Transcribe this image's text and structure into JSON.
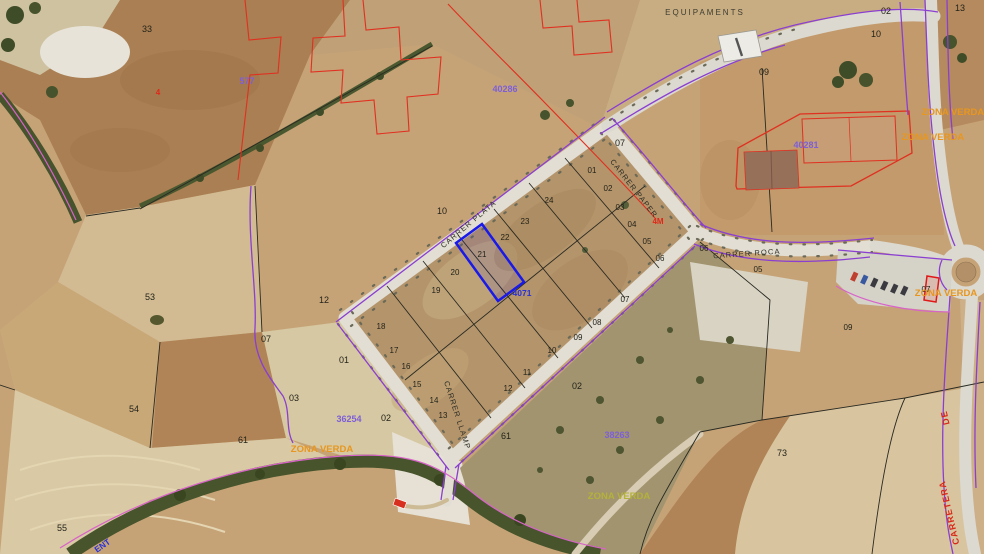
{
  "map_type": "aerial-cadastral-map",
  "palette": {
    "urban_boundary": "#8a3fd0",
    "torrent_line": "#d863c8",
    "survey_overlay_red": "#e03020",
    "selected_parcel_blue": "#1a1ae8",
    "cadastral_ref_purple": "#7d5fd8",
    "zone_label_orange": "#e8961e",
    "parcel_line_black": "#2a2a22",
    "road_fill": "#e2ded4"
  },
  "selected_parcel": {
    "lot_number": "21",
    "outline_color": "#1a1ae8"
  },
  "streets": [
    "CARRER PLATA",
    "CARRER PAPER",
    "CARRER ROCA",
    "CARRER LLAMP",
    "CARRETERA DE"
  ],
  "zones": [
    "EQUIPAMENTS",
    "ZONA VERDA"
  ],
  "cadastral_refs": [
    "577",
    "40286",
    "40281",
    "38263",
    "36254",
    "4071"
  ],
  "labels": [
    {
      "text": "EQUIPAMENTS",
      "kind": "zone-label",
      "color": "#3c3c30"
    },
    {
      "text": "33",
      "kind": "farm-parcel",
      "color": "#23231a"
    },
    {
      "text": "577",
      "kind": "cadastral-ref",
      "color": "#7d5fd8"
    },
    {
      "text": "4",
      "kind": "survey-mark",
      "color": "#e02818"
    },
    {
      "text": "40286",
      "kind": "cadastral-ref",
      "color": "#7d5fd8"
    },
    {
      "text": "02",
      "kind": "farm-parcel",
      "color": "#23231a"
    },
    {
      "text": "10",
      "kind": "farm-parcel",
      "color": "#23231a"
    },
    {
      "text": "13",
      "kind": "farm-parcel",
      "color": "#23231a"
    },
    {
      "text": "09",
      "kind": "farm-parcel",
      "color": "#23231a"
    },
    {
      "text": "07",
      "kind": "farm-parcel",
      "color": "#23231a"
    },
    {
      "text": "40281",
      "kind": "cadastral-ref",
      "color": "#7d5fd8"
    },
    {
      "text": "ZONA VERDA",
      "kind": "zone-label",
      "color": "#e8961e"
    },
    {
      "text": "ZONA VERDA",
      "kind": "zone-label",
      "color": "#e8961e"
    },
    {
      "text": "10",
      "kind": "farm-parcel",
      "color": "#23231a"
    },
    {
      "text": "53",
      "kind": "farm-parcel",
      "color": "#23231a"
    },
    {
      "text": "12",
      "kind": "farm-parcel",
      "color": "#23231a"
    },
    {
      "text": "07",
      "kind": "farm-parcel",
      "color": "#23231a"
    },
    {
      "text": "CARRER PLATA",
      "kind": "street-name",
      "color": "#2e2e24"
    },
    {
      "text": "CARRER PAPER",
      "kind": "street-name",
      "color": "#2e2e24"
    },
    {
      "text": "CARRER ROCA",
      "kind": "street-name",
      "color": "#2e2e24"
    },
    {
      "text": "CARRER LLAMP",
      "kind": "street-name",
      "color": "#2e2e24"
    },
    {
      "text": "4M",
      "kind": "dimension",
      "color": "#e02818"
    },
    {
      "text": "01",
      "kind": "lot-number",
      "color": "#23231a"
    },
    {
      "text": "02",
      "kind": "lot-number",
      "color": "#23231a"
    },
    {
      "text": "03",
      "kind": "lot-number",
      "color": "#23231a"
    },
    {
      "text": "04",
      "kind": "lot-number",
      "color": "#23231a"
    },
    {
      "text": "05",
      "kind": "lot-number",
      "color": "#23231a"
    },
    {
      "text": "06",
      "kind": "lot-number",
      "color": "#23231a"
    },
    {
      "text": "06",
      "kind": "lot-number",
      "color": "#23231a"
    },
    {
      "text": "05",
      "kind": "lot-number",
      "color": "#23231a"
    },
    {
      "text": "07",
      "kind": "lot-number",
      "color": "#23231a"
    },
    {
      "text": "08",
      "kind": "lot-number",
      "color": "#23231a"
    },
    {
      "text": "09",
      "kind": "lot-number",
      "color": "#23231a"
    },
    {
      "text": "10",
      "kind": "lot-number",
      "color": "#23231a"
    },
    {
      "text": "11",
      "kind": "lot-number",
      "color": "#23231a"
    },
    {
      "text": "12",
      "kind": "lot-number",
      "color": "#23231a"
    },
    {
      "text": "13",
      "kind": "lot-number",
      "color": "#23231a"
    },
    {
      "text": "14",
      "kind": "lot-number",
      "color": "#23231a"
    },
    {
      "text": "15",
      "kind": "lot-number",
      "color": "#23231a"
    },
    {
      "text": "16",
      "kind": "lot-number",
      "color": "#23231a"
    },
    {
      "text": "17",
      "kind": "lot-number",
      "color": "#23231a"
    },
    {
      "text": "18",
      "kind": "lot-number",
      "color": "#23231a"
    },
    {
      "text": "19",
      "kind": "lot-number",
      "color": "#23231a"
    },
    {
      "text": "20",
      "kind": "lot-number",
      "color": "#23231a"
    },
    {
      "text": "21",
      "kind": "lot-number-selected",
      "color": "#23231a"
    },
    {
      "text": "22",
      "kind": "lot-number",
      "color": "#23231a"
    },
    {
      "text": "23",
      "kind": "lot-number",
      "color": "#23231a"
    },
    {
      "text": "24",
      "kind": "lot-number",
      "color": "#23231a"
    },
    {
      "text": "4071",
      "kind": "cadastral-ref",
      "color": "#2830d8"
    },
    {
      "text": "09",
      "kind": "lot-number",
      "color": "#23231a"
    },
    {
      "text": "07",
      "kind": "lot-number",
      "color": "#23231a"
    },
    {
      "text": "ZONA VERDA",
      "kind": "zone-label",
      "color": "#e8961e"
    },
    {
      "text": "01",
      "kind": "farm-parcel",
      "color": "#23231a"
    },
    {
      "text": "03",
      "kind": "farm-parcel",
      "color": "#23231a"
    },
    {
      "text": "02",
      "kind": "farm-parcel",
      "color": "#23231a"
    },
    {
      "text": "36254",
      "kind": "cadastral-ref",
      "color": "#7d5fd8"
    },
    {
      "text": "ZONA VERDA",
      "kind": "zone-label",
      "color": "#e8961e"
    },
    {
      "text": "61",
      "kind": "farm-parcel",
      "color": "#23231a"
    },
    {
      "text": "54",
      "kind": "farm-parcel",
      "color": "#23231a"
    },
    {
      "text": "55",
      "kind": "farm-parcel",
      "color": "#23231a"
    },
    {
      "text": "61",
      "kind": "farm-parcel",
      "color": "#23231a"
    },
    {
      "text": "38263",
      "kind": "cadastral-ref",
      "color": "#7d5fd8"
    },
    {
      "text": "ZONA VERDA",
      "kind": "zone-label",
      "color": "#b5b23a"
    },
    {
      "text": "73",
      "kind": "farm-parcel",
      "color": "#23231a"
    },
    {
      "text": "02",
      "kind": "farm-parcel",
      "color": "#23231a"
    },
    {
      "text": "CARRETERA",
      "kind": "street-name",
      "color": "#d82818"
    },
    {
      "text": "DE",
      "kind": "street-name",
      "color": "#d82818"
    },
    {
      "text": "ENT",
      "kind": "watercourse-name",
      "color": "#2830d8"
    }
  ]
}
